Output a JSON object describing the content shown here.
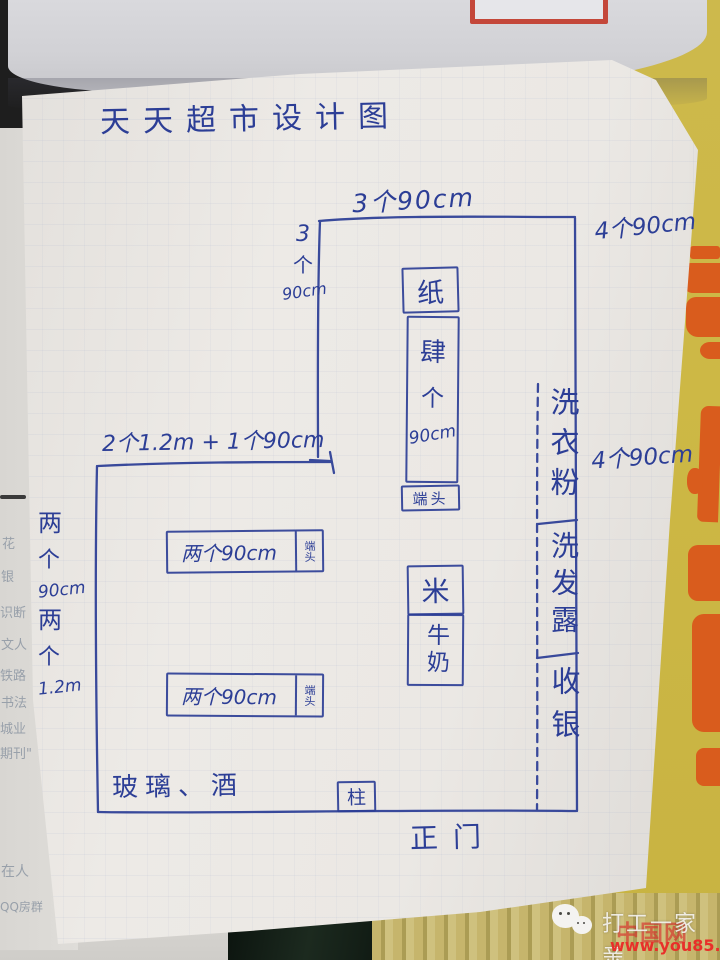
{
  "page": {
    "title": "天天超市设计图"
  },
  "dims": {
    "top_width": "3个90cm",
    "top_height": [
      "3",
      "个",
      "90cm"
    ],
    "right_top": "4个90cm",
    "right_mid": "4个90cm",
    "mid_width": "2个1.2m + 1个90cm",
    "left_upper": [
      "两",
      "个",
      "90cm"
    ],
    "left_lower": [
      "两",
      "个",
      "1.2m"
    ]
  },
  "fixtures": {
    "paper": "纸",
    "rack": [
      "肆",
      "个",
      "90cm"
    ],
    "endcap": "端头",
    "shelf_label": "两个90cm",
    "rice": "米",
    "milk": "牛奶",
    "washing_powder": "洗衣粉",
    "shampoo": "洗发露",
    "cashier": "收银",
    "glass_wine": "玻璃、酒",
    "pillar": "柱",
    "entrance": "正门"
  },
  "watermark": {
    "brand": "打工一家亲",
    "site": "www.you85.com",
    "ghost": "中国网"
  },
  "scraps": [
    "花",
    "银",
    "识断",
    "文人",
    "铁路",
    "书法",
    "城业",
    "期刊\"",
    "在人",
    "QQ房群"
  ],
  "colors": {
    "ink": "#2c3e96",
    "paper": "#eae7e3",
    "poster": "#cdb845",
    "accent": "#d95c1d",
    "red": "#e8302a"
  }
}
